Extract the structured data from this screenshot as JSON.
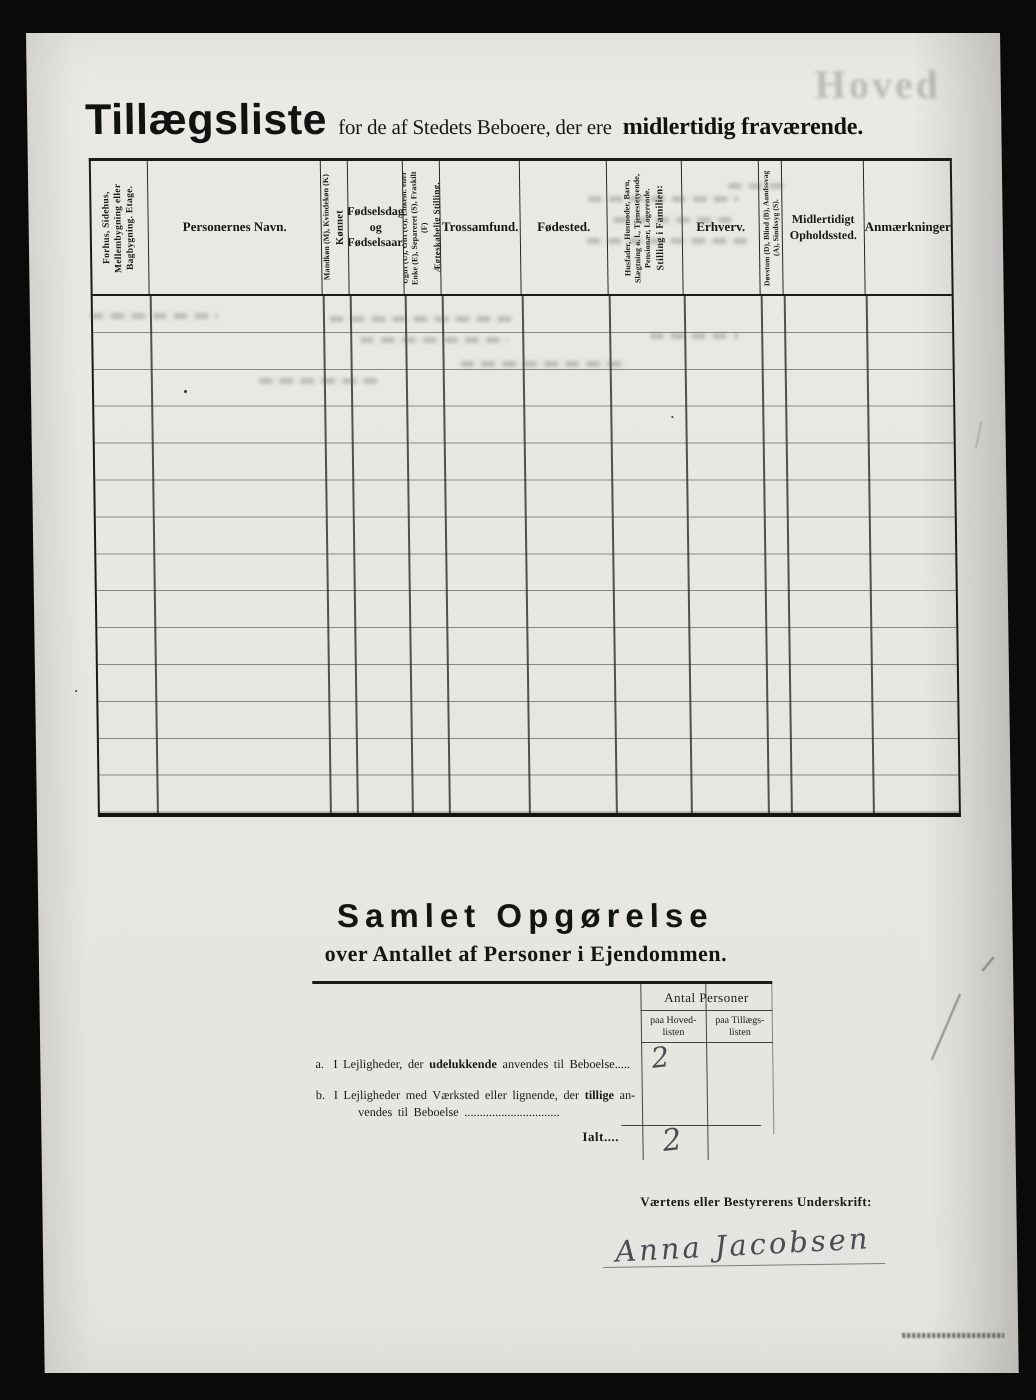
{
  "header": {
    "title": "Tillægsliste",
    "subtitle": "for de af Stedets Beboere, der ere",
    "subtitle_bold": "midlertidig fraværende.",
    "ghost_text": "Hoved"
  },
  "table": {
    "row_count": 14,
    "columns": [
      {
        "label": "Forhus, Sidehus, Mellembygning eller Bagbygning.   Etage."
      },
      {
        "label": "Personernes Navn."
      },
      {
        "label": "Kønnet",
        "sublabel": "Mandkøn (M), Kvindekøn (K)"
      },
      {
        "label": "Fødselsdag og Fødselsaar."
      },
      {
        "label": "Ægteskabelig Stilling.",
        "sublabel": "Ugift (U), Gift (G), Enkem. eller Enke (E), Separeret (S), Fraskilt (F)"
      },
      {
        "label": "Trossamfund."
      },
      {
        "label": "Fødested."
      },
      {
        "label": "Stilling i Familien:",
        "sublabel": "Husfader, Husmoder, Barn, Slægtning o. l., Tjenestetyende, Pensionær, Logerende."
      },
      {
        "label": "Erhverv."
      },
      {
        "label": "Døvstum (D), Blind (B), Aandssvag (A), Sindssyg (S)."
      },
      {
        "label": "Midlertidigt Opholdssted."
      },
      {
        "label": "Anmærkninger"
      }
    ]
  },
  "summary": {
    "title": "Samlet Opgørelse",
    "subtitle": "over Antallet af Personer i Ejendommen.",
    "count_header": "Antal Personer",
    "col_hoved": "paa Hoved- listen",
    "col_tillaegs": "paa Tillægs- listen",
    "row_a": {
      "index": "a.",
      "t1": "I Lejligheder, der",
      "bold": "udelukkende",
      "t2": "anvendes til Beboelse",
      "dots": ".....",
      "value_hovedlisten": "2"
    },
    "row_b": {
      "index": "b.",
      "t1": "I Lejligheder med Værksted eller lignende, der",
      "bold": "tillige",
      "t2": "an-",
      "t3": "vendes til Beboelse",
      "dots": "..............................."
    },
    "total": {
      "label": "Ialt",
      "dots": "....",
      "value_hovedlisten": "2"
    }
  },
  "signature": {
    "label": "Værtens eller Bestyrerens Underskrift:",
    "name": "Anna Jacobsen"
  }
}
